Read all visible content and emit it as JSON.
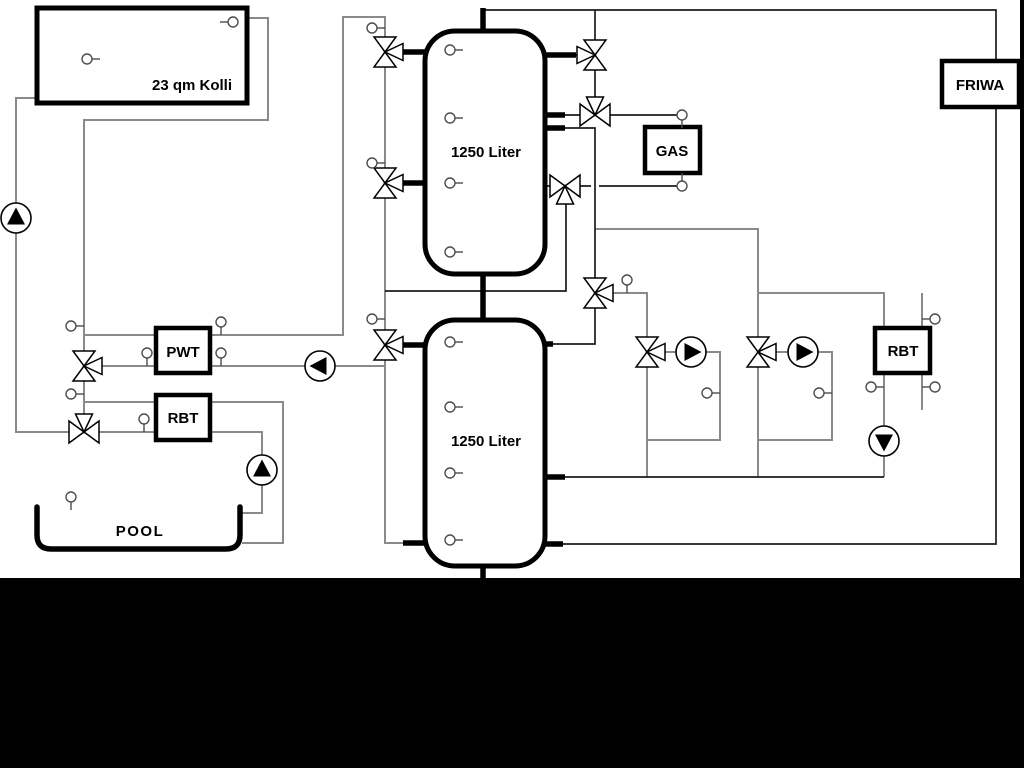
{
  "scheme": {
    "collector_label": "23 qm Kolli",
    "upper_tank_label": "1250 Liter",
    "lower_tank_label": "1250 Liter",
    "gas_label": "GAS",
    "friwa_label": "FRIWA",
    "pwt_label": "PWT",
    "rbt_pool_label": "RBT",
    "rbt_right_label": "RBT",
    "pool_label": "POOL"
  },
  "colors": {
    "background": "#ffffff",
    "matte": "#000000",
    "pipe_gray": "#8a8a8a",
    "pipe_dark": "#1c1c1c",
    "component_stroke": "#000000"
  }
}
